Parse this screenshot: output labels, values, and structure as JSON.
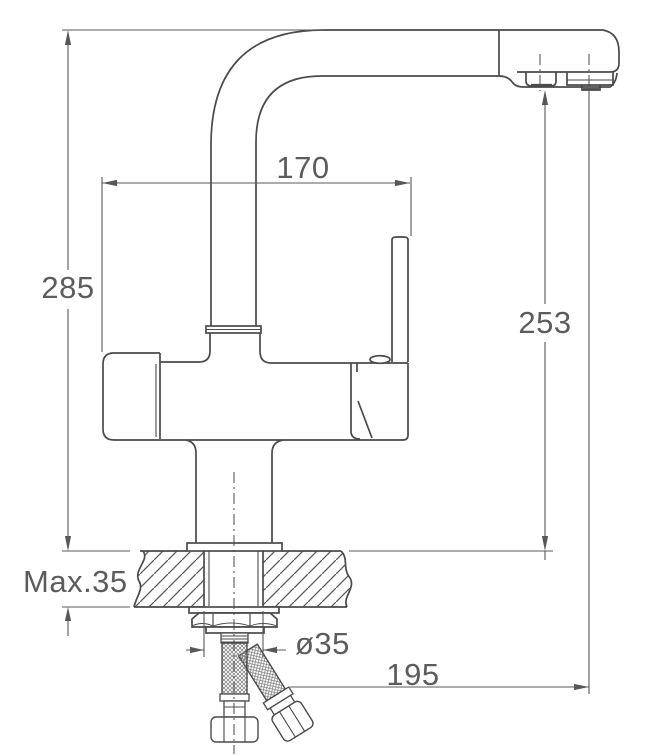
{
  "meta": {
    "drawing_type": "technical dimension drawing",
    "subject": "kitchen mixer faucet, side elevation with countertop cross-section and supply hoses",
    "background": "#ffffff",
    "line_color": "#4a4a4a",
    "text_color": "#5c5c5c"
  },
  "dimensions": {
    "overall_height": {
      "label": "285",
      "value": 285
    },
    "spout_reach": {
      "label": "170",
      "value": 170
    },
    "outlet_height": {
      "label": "253",
      "value": 253
    },
    "max_counter_thickness": {
      "label": "Max.35",
      "value": 35
    },
    "mounting_hole_diameter": {
      "label": "ø35",
      "value": 35
    },
    "hose_extent": {
      "label": "195",
      "value": 195
    }
  }
}
